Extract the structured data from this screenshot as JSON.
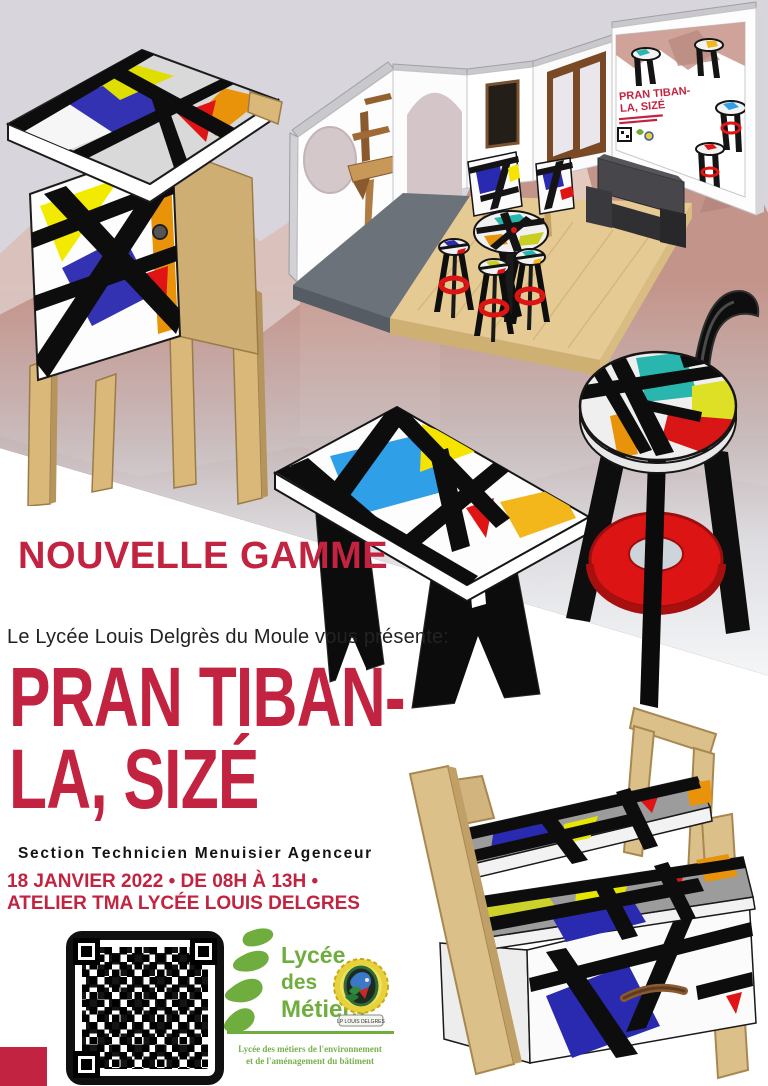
{
  "poster": {
    "range_label": "NOUVELLE GAMME",
    "intro": "Le Lycée Louis Delgrès du Moule vous présente:",
    "title_line1": "PRAN TIBAN-",
    "title_line2": "LA, SIZÉ",
    "section": "Section Technicien Menuisier Agenceur",
    "event_line1": "18 JANVIER 2022 • DE 08H À 13H •",
    "event_line2": "ATELIER TMA LYCÉE LOUIS DELGRES"
  },
  "wall_poster": {
    "title_line1": "PRAN TIBAN-",
    "title_line2": "LA, SIZÉ"
  },
  "footer": {
    "logo": {
      "line1": "Lycée",
      "line2": "des",
      "line3": "Métiers",
      "caption_line1": "Lycée des métiers de l'environnement",
      "caption_line2": "et de l'aménagement du bâtiment"
    },
    "emblem_banner": "LP LOUIS DELGRES"
  },
  "colors": {
    "accent_red": "#c22340",
    "mondrian_blue": "#3232b2",
    "sky_blue": "#2f9fe8",
    "yellow": "#f6e400",
    "amber": "#f3b71c",
    "orange": "#e8930a",
    "bright_red": "#e01414",
    "teal": "#28b6ae",
    "wood": "#d9b87a",
    "logo_green": "#6fae3e",
    "mountain_pink": "#c99b90"
  }
}
